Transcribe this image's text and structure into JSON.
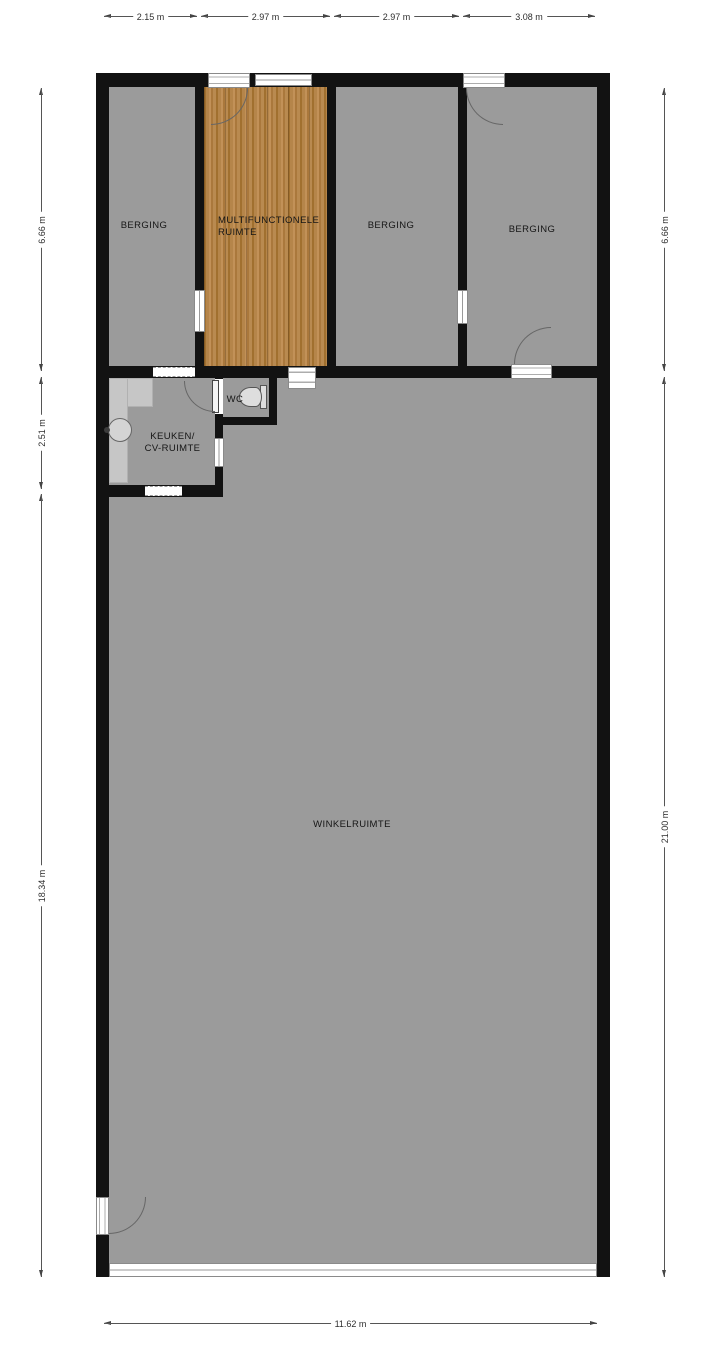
{
  "rooms": {
    "berging1": {
      "label": "BERGING"
    },
    "multifunctionele_ruimte": {
      "line1": "MULTIFUNCTIONELE",
      "line2": "RUIMTE"
    },
    "berging2": {
      "label": "BERGING"
    },
    "berging3": {
      "label": "BERGING"
    },
    "keuken": {
      "line1": "KEUKEN/",
      "line2": "CV-RUIMTE"
    },
    "wc": {
      "label": "WC"
    },
    "winkelruimte": {
      "label": "WINKELRUIMTE"
    }
  },
  "dimensions": {
    "top": [
      "2.15 m",
      "2.97 m",
      "2.97 m",
      "3.08 m"
    ],
    "left": [
      "6.66 m",
      "2.51 m",
      "18.34 m"
    ],
    "right": [
      "6.66 m",
      "21.00 m"
    ],
    "bottom": [
      "11.62 m"
    ]
  },
  "colors": {
    "bg": "#ffffff",
    "wall": "#121212",
    "floor": "#9b9b9b",
    "wood": "#b0803f",
    "counter": "#c6c6c6"
  }
}
